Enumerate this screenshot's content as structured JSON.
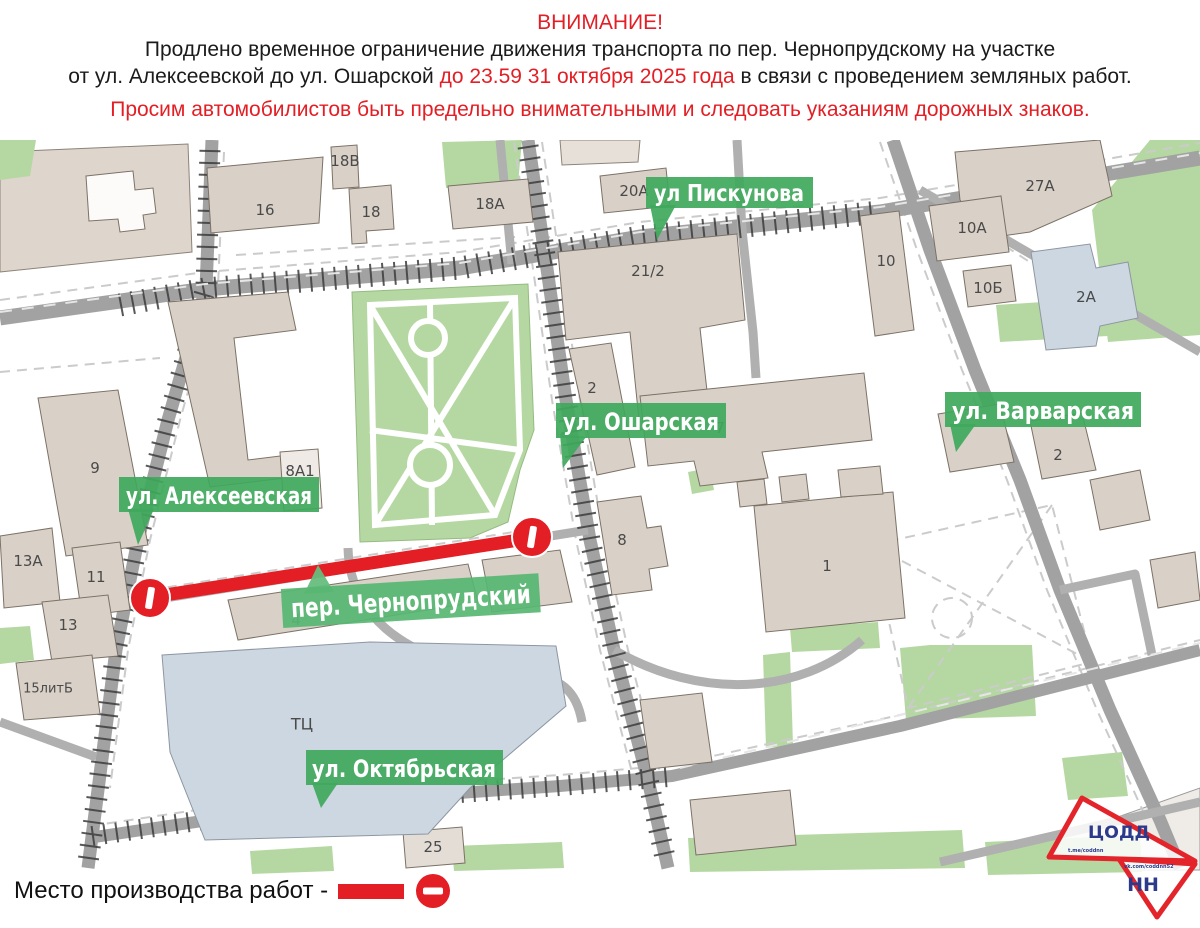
{
  "header": {
    "attention": "ВНИМАНИЕ!",
    "line1": "Продлено временное ограничение движения транспорта по пер. Чернопрудскому на участке",
    "line2_start": "от ул. Алексеевской до ул. Ошарской ",
    "line2_red": "до 23.59 31 октября 2025 года",
    "line2_end": " в связи с проведением земляных работ.",
    "line3": "Просим автомобилистов быть предельно внимательными и следовать указаниям дорожных знаков."
  },
  "map": {
    "street_labels": {
      "piskunova": "ул Пискунова",
      "osharskaya": "ул. Ошарская",
      "varvarskaya": "ул. Варварская",
      "alekseevskaya": "ул. Алексеевская",
      "chernoprudsky": "пер. Чернопрудский",
      "oktyabrskaya": "ул. Октябрьская"
    },
    "buildings": {
      "b16": "16",
      "b18": "18",
      "b18v": "18В",
      "b18a": "18А",
      "b20a": "20А",
      "b21_2": "21/2",
      "b27a": "27А",
      "b10a": "10А",
      "b10": "10",
      "b10b": "10Б",
      "b2a": "2А",
      "b2osh": "2",
      "b7": "7",
      "b9": "9",
      "b8a1": "8А1",
      "b13a": "13А",
      "b11": "11",
      "b13": "13",
      "b15litb": "15литБ",
      "b4": "4",
      "b8": "8",
      "b1": "1",
      "b2var": "2",
      "btc": "ТЦ",
      "b25": "25"
    }
  },
  "legend": {
    "label": "Место производства работ -"
  },
  "logo": {
    "top": "ЦОДД",
    "bottom": "НН",
    "social_top": "t.me/coddnn",
    "social_bottom": "vk.com/coddnn52"
  },
  "colors": {
    "accent_red": "#E31E24",
    "label_green": "#3FA85C",
    "park_green": "#B5D8A2",
    "building_fill": "#D9D0C7",
    "mall_blue": "#CCD7E1",
    "road_gray": "#A2A2A2"
  }
}
